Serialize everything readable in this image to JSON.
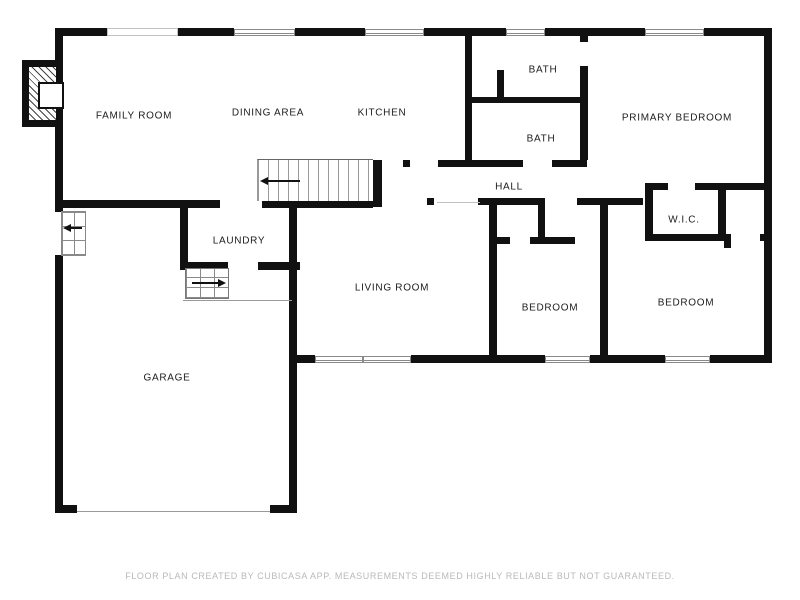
{
  "title": "Floor plan",
  "rooms": [
    {
      "id": "family-room",
      "label": "FAMILY ROOM",
      "x": 134,
      "y": 116
    },
    {
      "id": "dining-area",
      "label": "DINING AREA",
      "x": 268,
      "y": 113
    },
    {
      "id": "kitchen",
      "label": "KITCHEN",
      "x": 382,
      "y": 113
    },
    {
      "id": "bath-upper",
      "label": "BATH",
      "x": 543,
      "y": 70
    },
    {
      "id": "bath-lower",
      "label": "BATH",
      "x": 541,
      "y": 139
    },
    {
      "id": "primary-bedroom",
      "label": "PRIMARY BEDROOM",
      "x": 677,
      "y": 118
    },
    {
      "id": "hall",
      "label": "HALL",
      "x": 509,
      "y": 187
    },
    {
      "id": "wic",
      "label": "W.I.C.",
      "x": 684,
      "y": 220
    },
    {
      "id": "laundry",
      "label": "LAUNDRY",
      "x": 239,
      "y": 241
    },
    {
      "id": "living-room",
      "label": "LIVING ROOM",
      "x": 392,
      "y": 288
    },
    {
      "id": "bedroom-middle",
      "label": "BEDROOM",
      "x": 550,
      "y": 308
    },
    {
      "id": "bedroom-right",
      "label": "BEDROOM",
      "x": 686,
      "y": 303
    },
    {
      "id": "garage",
      "label": "GARAGE",
      "x": 167,
      "y": 378
    }
  ],
  "footer": {
    "disclaimer": "FLOOR PLAN CREATED BY CUBICASA APP. MEASUREMENTS DEEMED HIGHLY RELIABLE BUT NOT GUARANTEED."
  },
  "icons": [
    "fireplace-icon",
    "stairs-up-arrow-icon",
    "steps-arrow-icon",
    "side-steps-arrow-icon",
    "window",
    "door-opening"
  ],
  "colors": {
    "wall": "#111111",
    "window_border": "#8a8a8a",
    "stair_line": "#9a9a9a",
    "label_text": "#1c1c1c",
    "footer_text": "#b9b9b9",
    "background": "#ffffff"
  }
}
